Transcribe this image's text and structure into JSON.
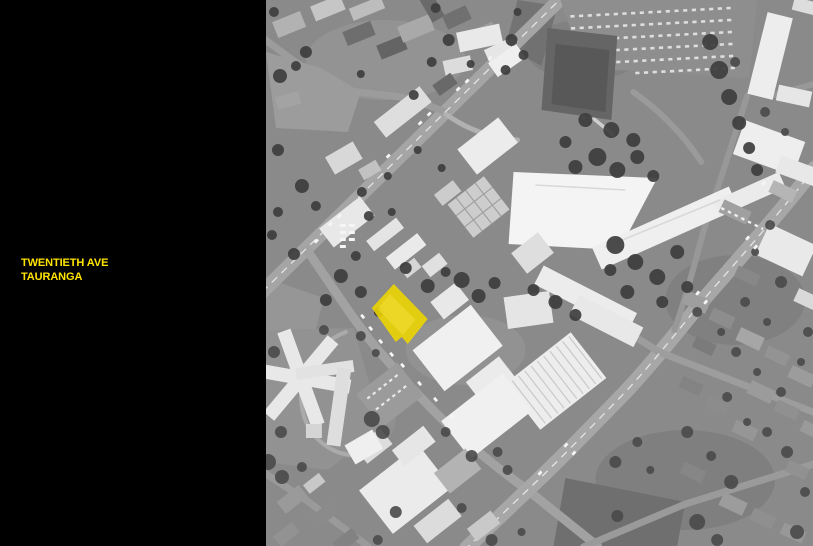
{
  "colors": {
    "panel_bg": "#000000",
    "accent_yellow": "#ffe400",
    "highlight_yellow": "#eed600",
    "photo_base": "#8a8a8a"
  },
  "panel": {
    "title_lines": [
      "TWENTIETH AVE",
      "TAURANGA"
    ]
  },
  "map": {
    "kind": "grayscale aerial photograph",
    "highlight": "site parcel highlighted in yellow"
  }
}
